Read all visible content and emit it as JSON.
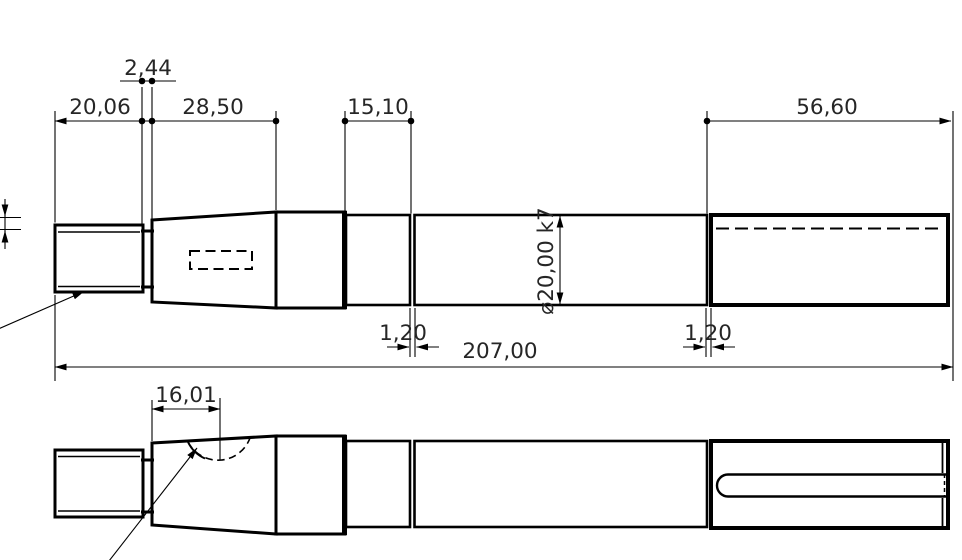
{
  "drawing": {
    "type": "technical-drawing",
    "part": "stepped shaft, two orthographic views",
    "background": "#ffffff",
    "line_color": "#000000",
    "text_color": "#262626",
    "dims": {
      "neck_width": "2,44",
      "thread_length": "20,06",
      "taper_length": "28,50",
      "collar_length": "15,10",
      "keyway_section_length": "56,60",
      "shaft_diameter": "⌀20,00 k7",
      "relief_groove_left": "1,20",
      "relief_groove_right": "1,20",
      "overall_length": "207,00",
      "keyseat_position": "16,01"
    }
  }
}
